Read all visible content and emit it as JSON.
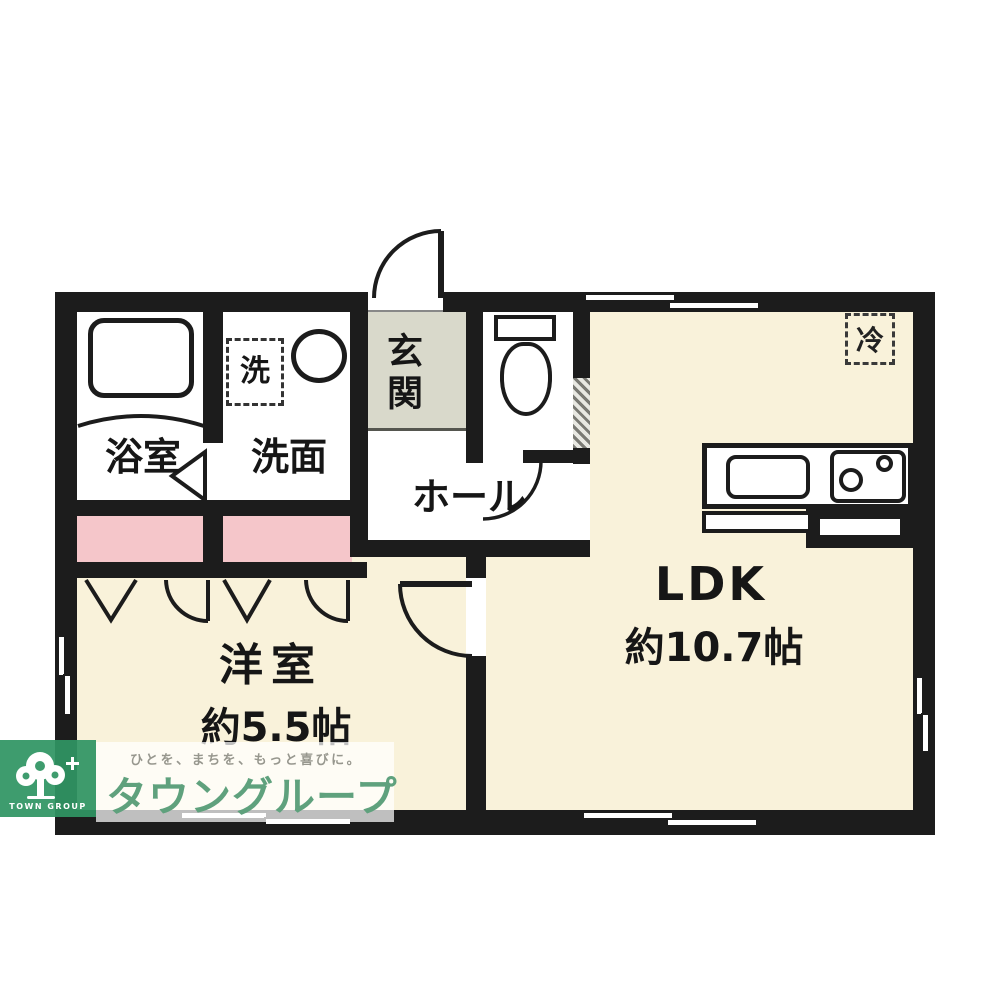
{
  "floorplan": {
    "type": "apartment-floor-plan-1LDK",
    "labels": {
      "bath": "浴室",
      "washroom": "洗面",
      "washer": "洗",
      "entrance": "玄関",
      "hall": "ホール",
      "ldk_name": "LDK",
      "ldk_area": "約10.7帖",
      "bedroom_name": "洋室",
      "bedroom_area": "約5.5帖",
      "fridge": "冷"
    },
    "colors": {
      "wall": "#1c1c1c",
      "room_floor_cream": "#f9f2da",
      "closet_pink": "#f5c6ca",
      "entrance_gray": "#d9d9cb",
      "logo_green": "#2f9463",
      "brand_text_green": "#5fa17d",
      "tagline_gray": "#97978e"
    }
  },
  "logo": {
    "tagline": "ひとを、まちを、もっと喜びに。",
    "brand": "タウングループ",
    "name": "TOWN GROUP"
  }
}
